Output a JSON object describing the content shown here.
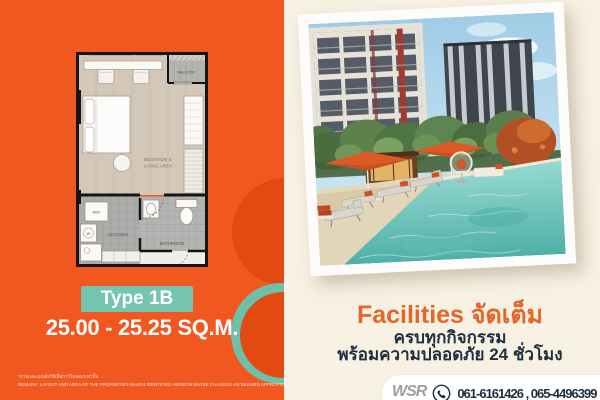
{
  "left_panel": {
    "floor_plan": {
      "balcony_label": "BALCONY",
      "bedroom_label_line1": "BEDROOM &",
      "bedroom_label_line2": "LIVING AREA",
      "kitchen_label": "KITCHEN",
      "bathroom_label": "BATHROOM",
      "fridge_label": "REF",
      "washer_label": "W"
    },
    "type_badge_label": "Type 1B",
    "area_text": "25.00 - 25.25 SQ.M.",
    "disclaimer_thai": "*ภาพและแผนผังใช้เพื่อการโฆษณาเท่านั้น",
    "disclaimer_english": "REMARK: LAYOUT AND AREA OF THE PROPERTIES WHICH IDENTIFIED HEREON MAYBE CHANGED AS DEEMED APPROPRIATE,BUT WILL NOT IMPACT UPON THE USE"
  },
  "right_panel": {
    "facilities_headline": "Facilities จัดเต็ม",
    "facilities_subline1": "ครบทุกกิจกรรม",
    "facilities_subline2": "พร้อมความปลอดภัย 24 ชั่วโมง",
    "contact": {
      "logo_text": "WSR",
      "phone_numbers": "061-6161426 , 065-4496399"
    }
  },
  "colors": {
    "orange_panel": "#F1581F",
    "orange_deep": "#E24A12",
    "teal_accent": "#74C4B0",
    "cream_background": "#F7F1E3",
    "navy_text": "#20303F",
    "orange_headline": "#E4662B",
    "white": "#FFFFFF"
  }
}
